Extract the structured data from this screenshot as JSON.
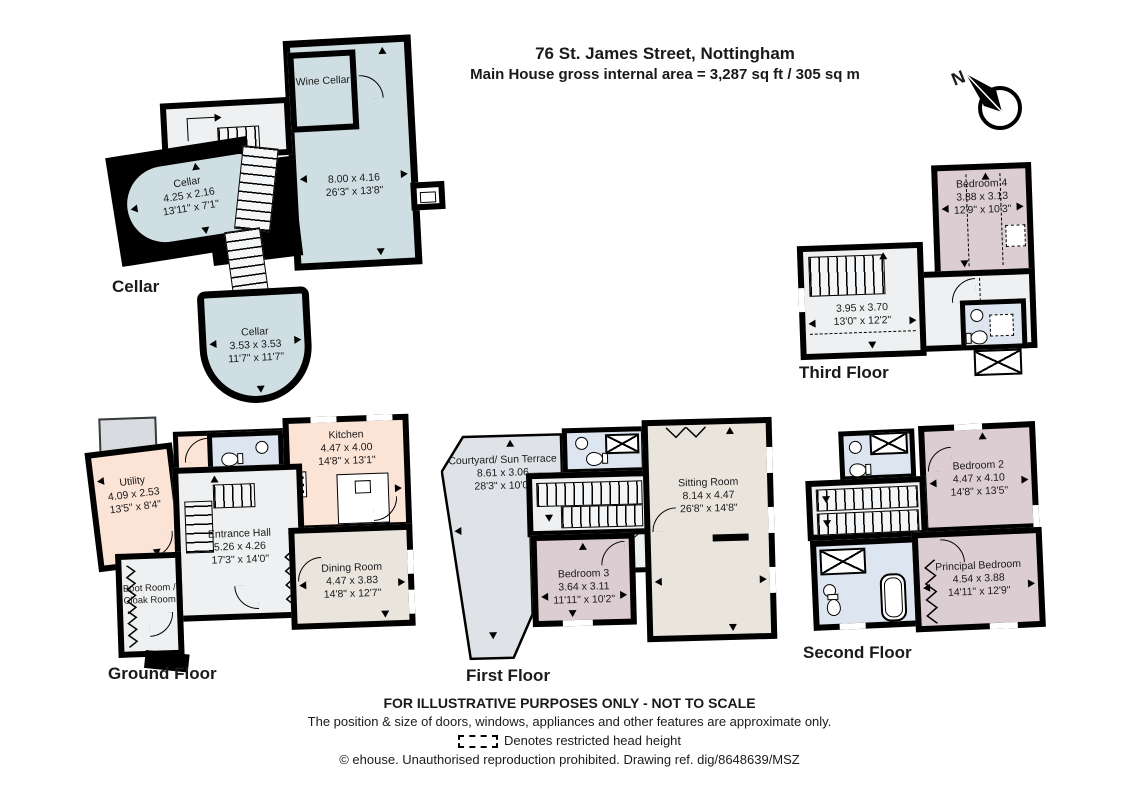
{
  "title": {
    "line1": "76 St. James Street, Nottingham",
    "line2": "Main House gross internal area = 3,287 sq ft / 305 sq m"
  },
  "compass": {
    "north": "N"
  },
  "palette": {
    "wall": "#000000",
    "cellar_room": "#cfdee2",
    "bedroom": "#dccdd3",
    "kitchen_utility": "#fbe3d6",
    "living": "#e9e5dd",
    "bathroom": "#dde5f0",
    "hall": "#eef0f1",
    "courtyard": "#dfe3e8"
  },
  "floors": {
    "cellar": {
      "label": "Cellar",
      "rooms": {
        "wine": {
          "name": "Wine Cellar"
        },
        "main": {
          "metric": "8.00 x 4.16",
          "imperial": "26'3\" x 13'8\""
        },
        "west": {
          "name": "Cellar",
          "metric": "4.25 x 2.16",
          "imperial": "13'11\" x 7'1\""
        },
        "round": {
          "name": "Cellar",
          "metric": "3.53 x 3.53",
          "imperial": "11'7\" x 11'7\""
        }
      }
    },
    "ground": {
      "label": "Ground Floor",
      "rooms": {
        "utility": {
          "name": "Utility",
          "metric": "4.09 x 2.53",
          "imperial": "13'5\" x 8'4\""
        },
        "kitchen": {
          "name": "Kitchen",
          "metric": "4.47 x 4.00",
          "imperial": "14'8\" x 13'1\""
        },
        "entrance": {
          "name": "Entrance Hall",
          "metric": "5.26 x 4.26",
          "imperial": "17'3\" x 14'0\""
        },
        "dining": {
          "name": "Dining Room",
          "metric": "4.47 x 3.83",
          "imperial": "14'8\" x 12'7\""
        },
        "boot": {
          "name": "Boot Room / Cloak Room"
        }
      }
    },
    "first": {
      "label": "First Floor",
      "rooms": {
        "courtyard": {
          "name": "Courtyard/ Sun Terrace",
          "metric": "8.61 x 3.06",
          "imperial": "28'3\" x 10'0\""
        },
        "sitting": {
          "name": "Sitting Room",
          "metric": "8.14 x 4.47",
          "imperial": "26'8\" x 14'8\""
        },
        "bedroom3": {
          "name": "Bedroom 3",
          "metric": "3.64 x 3.11",
          "imperial": "11'11\" x 10'2\""
        }
      }
    },
    "second": {
      "label": "Second Floor",
      "rooms": {
        "bedroom2": {
          "name": "Bedroom 2",
          "metric": "4.47 x 4.10",
          "imperial": "14'8\" x 13'5\""
        },
        "principal": {
          "name": "Principal Bedroom",
          "metric": "4.54 x 3.88",
          "imperial": "14'11\" x 12'9\""
        }
      }
    },
    "third": {
      "label": "Third Floor",
      "rooms": {
        "bedroom4": {
          "name": "Bedroom 4",
          "metric": "3.88 x 3.13",
          "imperial": "12'9\" x 10'3\""
        },
        "landing": {
          "metric": "3.95 x 3.70",
          "imperial": "13'0\" x 12'2\""
        }
      }
    }
  },
  "footer": {
    "line1": "FOR ILLUSTRATIVE PURPOSES ONLY - NOT TO SCALE",
    "line2": "The position & size of doors, windows, appliances and other features are approximate only.",
    "line3": "Denotes restricted head height",
    "line4": "© ehouse. Unauthorised reproduction prohibited. Drawing ref. dig/8648639/MSZ"
  }
}
